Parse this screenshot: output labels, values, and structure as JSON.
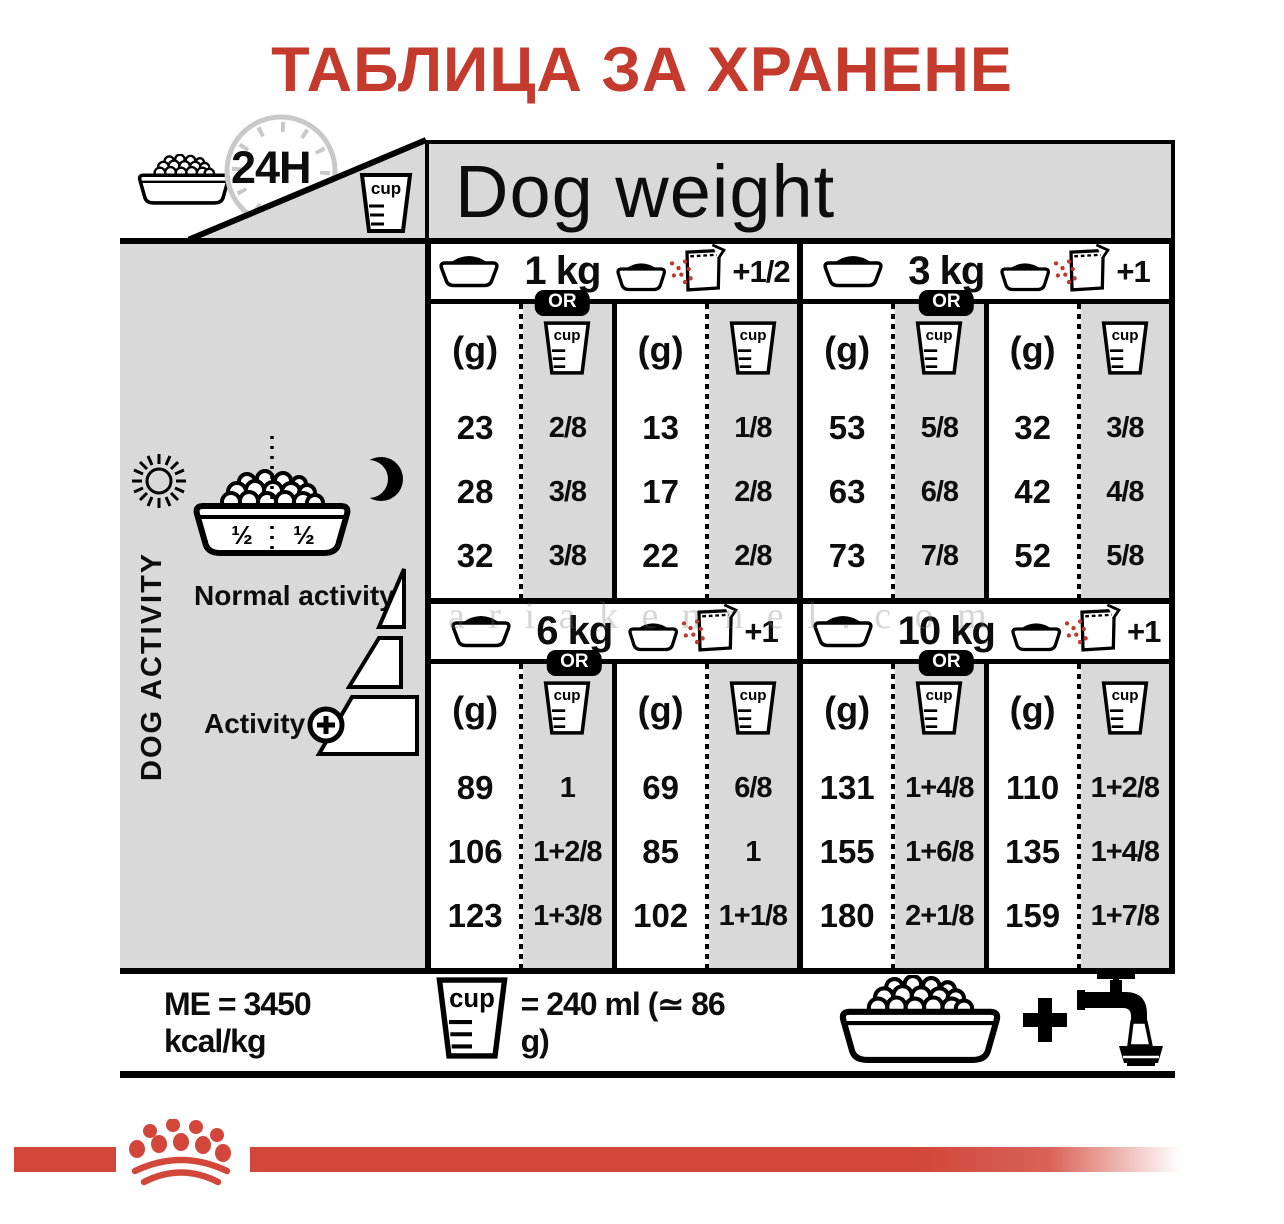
{
  "title": "ТАБЛИЦА ЗА ХРАНЕНЕ",
  "header": {
    "dog_weight": "Dog weight",
    "clock": "24H"
  },
  "units": {
    "g": "(g)",
    "cup": "cup"
  },
  "sidebar": {
    "half_left": "½",
    "half_right": "½",
    "dog_activity": "DOG ACTIVITY",
    "normal_activity": "Normal activity",
    "activity": "Activity"
  },
  "sections": [
    {
      "weight": "1 kg",
      "or_label": "OR",
      "extra": "+1/2",
      "pairs": [
        {
          "g": [
            "23",
            "28",
            "32"
          ],
          "cup": [
            "2/8",
            "3/8",
            "3/8"
          ]
        },
        {
          "g": [
            "13",
            "17",
            "22"
          ],
          "cup": [
            "1/8",
            "2/8",
            "2/8"
          ]
        }
      ]
    },
    {
      "weight": "3 kg",
      "or_label": "OR",
      "extra": "+1",
      "pairs": [
        {
          "g": [
            "53",
            "63",
            "73"
          ],
          "cup": [
            "5/8",
            "6/8",
            "7/8"
          ]
        },
        {
          "g": [
            "32",
            "42",
            "52"
          ],
          "cup": [
            "3/8",
            "4/8",
            "5/8"
          ]
        }
      ]
    },
    {
      "weight": "6 kg",
      "or_label": "OR",
      "extra": "+1",
      "pairs": [
        {
          "g": [
            "89",
            "106",
            "123"
          ],
          "cup": [
            "1",
            "1+2/8",
            "1+3/8"
          ]
        },
        {
          "g": [
            "69",
            "85",
            "102"
          ],
          "cup": [
            "6/8",
            "1",
            "1+1/8"
          ]
        }
      ]
    },
    {
      "weight": "10 kg",
      "or_label": "OR",
      "extra": "+1",
      "pairs": [
        {
          "g": [
            "131",
            "155",
            "180"
          ],
          "cup": [
            "1+4/8",
            "1+6/8",
            "2+1/8"
          ]
        },
        {
          "g": [
            "110",
            "135",
            "159"
          ],
          "cup": [
            "1+2/8",
            "1+4/8",
            "1+7/8"
          ]
        }
      ]
    }
  ],
  "footer": {
    "me": "ME = 3450 kcal/kg",
    "cup_equals": "= 240 ml (≃ 86 g)"
  },
  "watermark": "a r i a k e n n e l . c o m",
  "colors": {
    "title_red": "#c43a2c",
    "brand_red": "#d2473a",
    "panel_gray": "#d9d9d9",
    "speckle_red": "#c0392b"
  }
}
